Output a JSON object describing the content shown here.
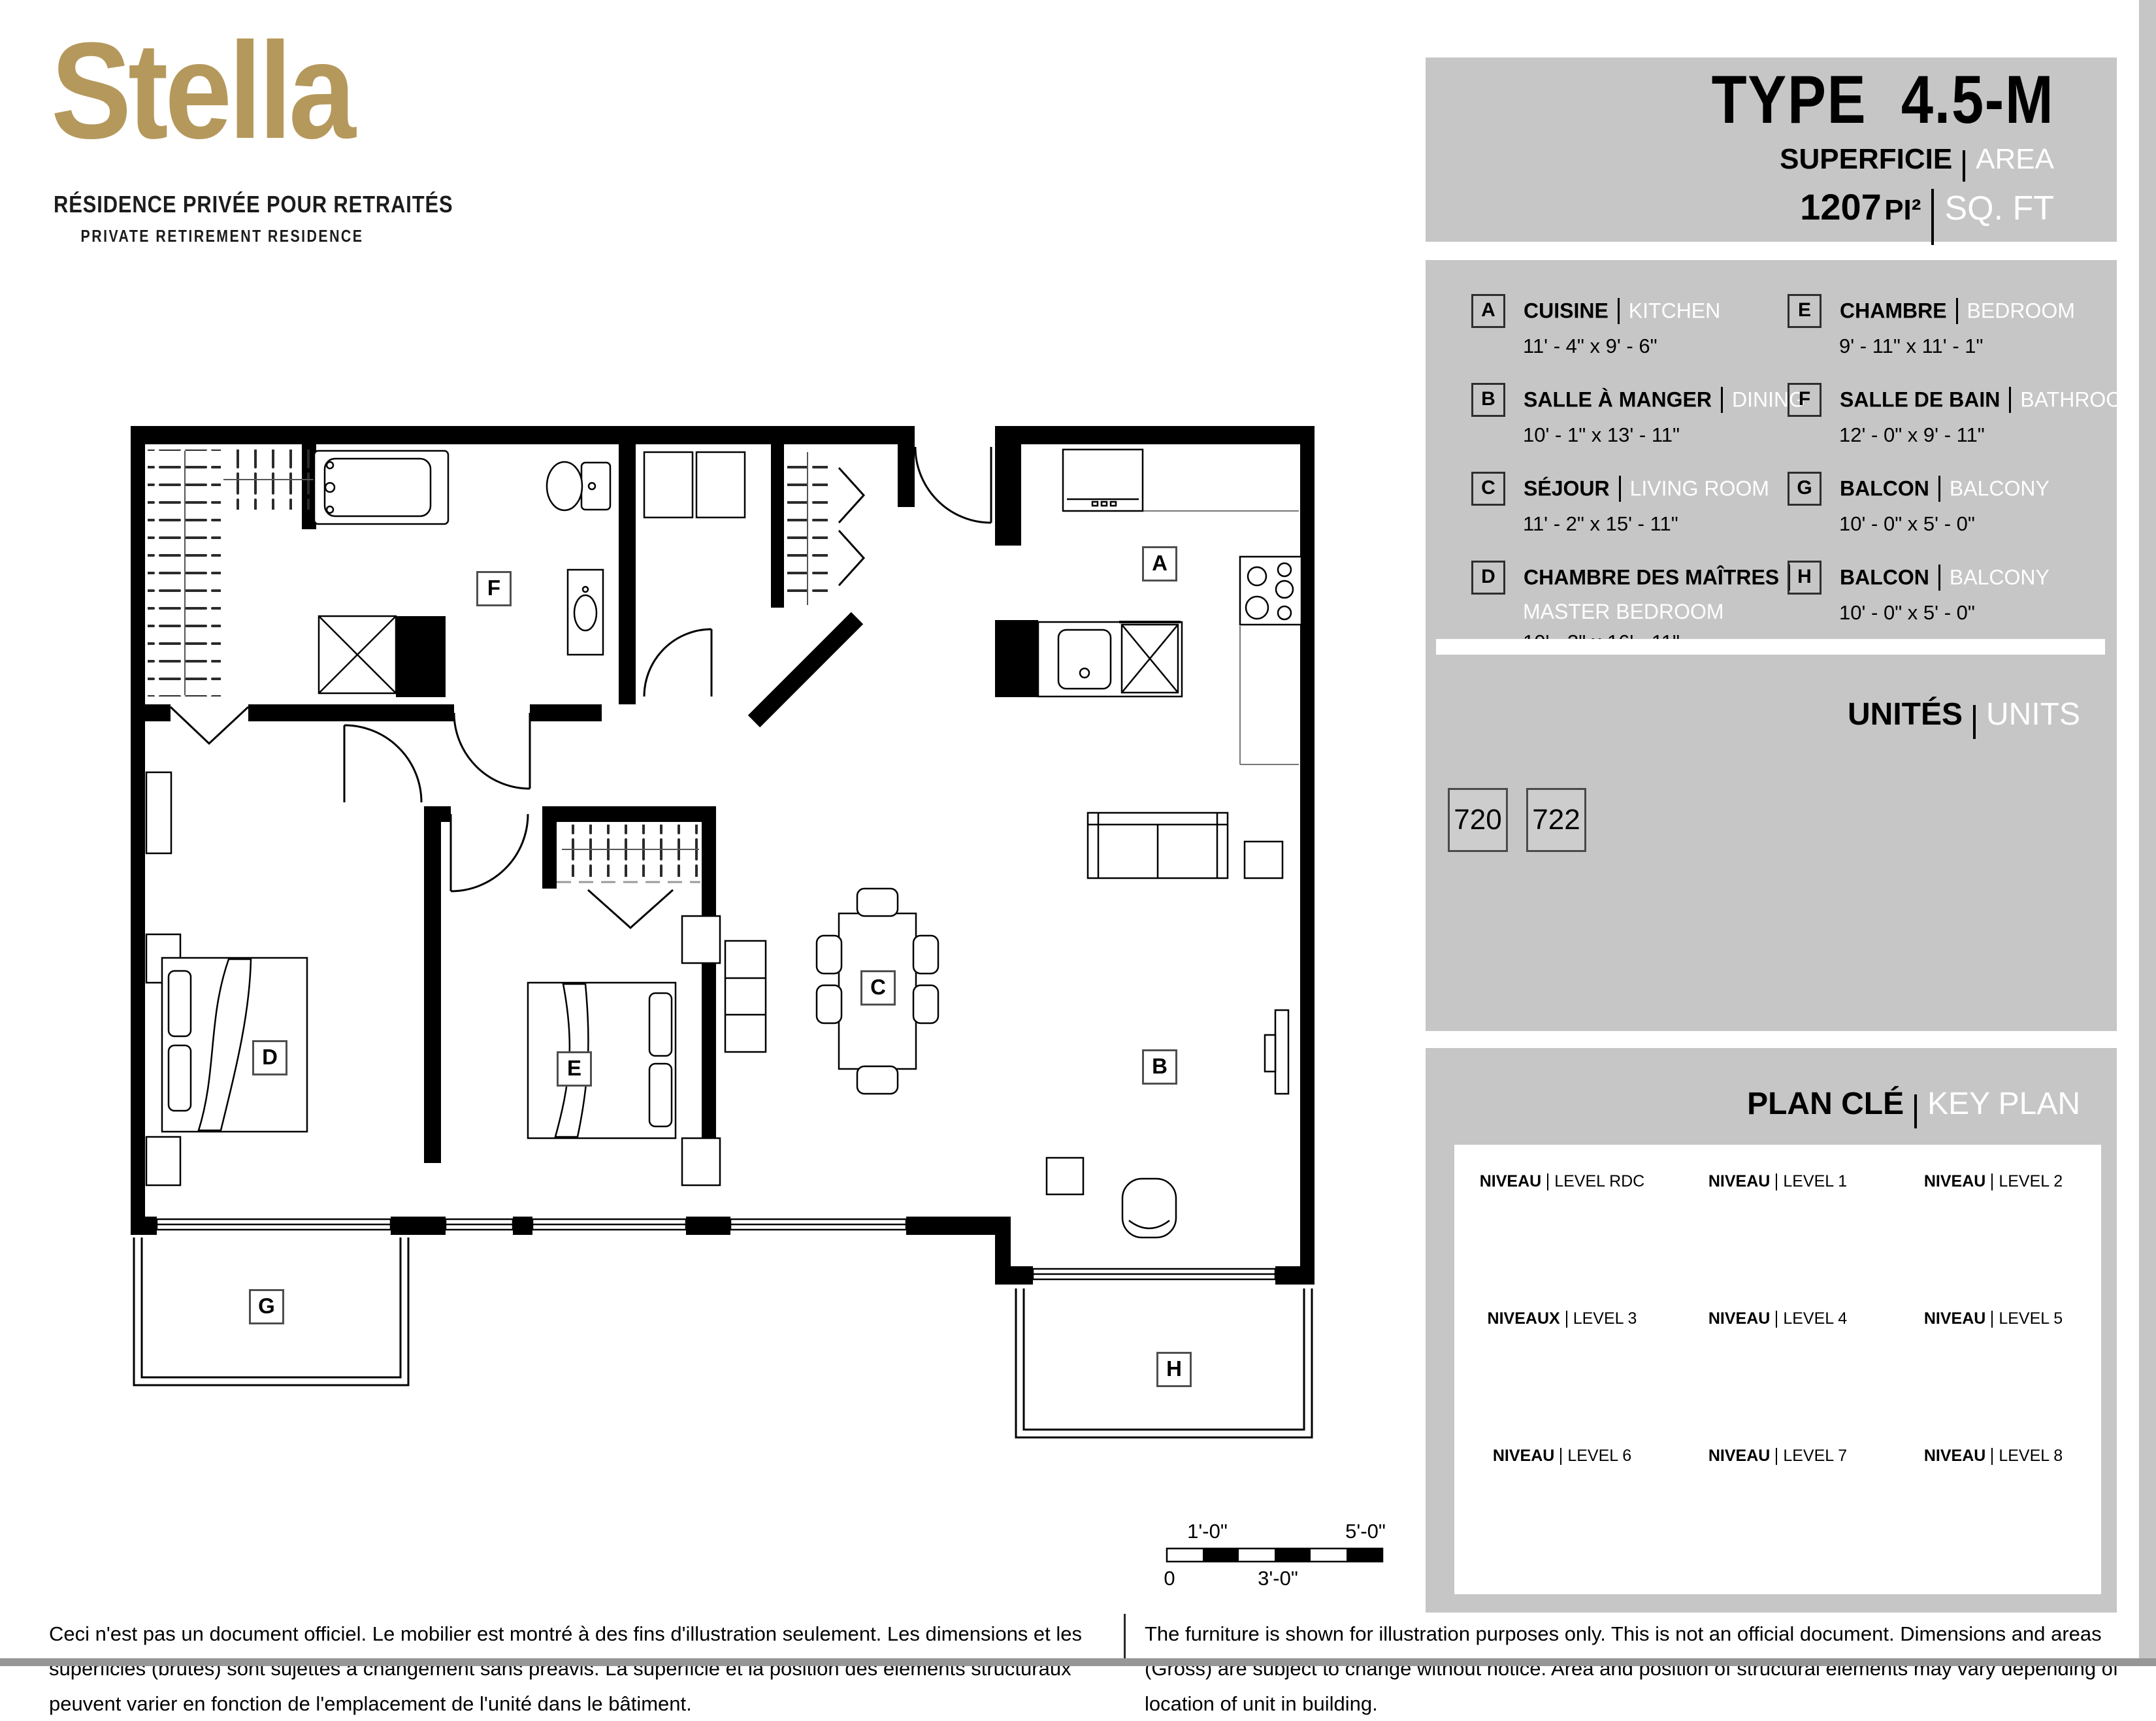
{
  "logo": {
    "name": "Stella",
    "tagline_fr": "RÉSIDENCE PRIVÉE POUR RETRAITÉS",
    "tagline_en": "PRIVATE RETIREMENT RESIDENCE"
  },
  "header": {
    "type_label": "TYPE",
    "type_value": "4.5-M",
    "area_label_fr": "SUPERFICIE",
    "area_label_en": "AREA",
    "area_value": "1207",
    "area_unit_fr": "PI²",
    "area_unit_en": "SQ. FT"
  },
  "legend": {
    "left": [
      {
        "letter": "A",
        "name_fr": "CUISINE",
        "name_en": "KITCHEN",
        "dim": "11' - 4\" x 9' - 6\"",
        "en_below": false
      },
      {
        "letter": "B",
        "name_fr": "SALLE À MANGER",
        "name_en": "DINING",
        "dim": "10' - 1\" x 13' - 11\"",
        "en_below": false
      },
      {
        "letter": "C",
        "name_fr": "SÉJOUR",
        "name_en": "LIVING ROOM",
        "dim": "11' - 2\" x 15' - 11\"",
        "en_below": false
      },
      {
        "letter": "D",
        "name_fr": "CHAMBRE DES MAÎTRES",
        "name_en": "MASTER BEDROOM",
        "dim": "10' - 3\" x 16' - 11\"",
        "en_below": true
      }
    ],
    "right": [
      {
        "letter": "E",
        "name_fr": "CHAMBRE",
        "name_en": "BEDROOM",
        "dim": "9' - 11\" x 11' - 1\"",
        "en_below": false
      },
      {
        "letter": "F",
        "name_fr": "SALLE DE BAIN",
        "name_en": "BATHROOM",
        "dim": "12' - 0\" x 9' - 11\"",
        "en_below": false
      },
      {
        "letter": "G",
        "name_fr": "BALCON",
        "name_en": "BALCONY",
        "dim": "10' - 0\" x 5' - 0\"",
        "en_below": false
      },
      {
        "letter": "H",
        "name_fr": "BALCON",
        "name_en": "BALCONY",
        "dim": "10' - 0\" x 5' - 0\"",
        "en_below": false
      }
    ]
  },
  "units": {
    "label_fr": "UNITÉS",
    "label_en": "UNITS",
    "numbers": [
      "720",
      "722"
    ]
  },
  "keyplan": {
    "title_fr": "PLAN CLÉ",
    "title_en": "KEY PLAN",
    "compass": "N",
    "highlight_color": "#b2a7cb",
    "levels": [
      {
        "fr": "NIVEAU",
        "en": "LEVEL RDC",
        "shape": "rdc",
        "highlight": false
      },
      {
        "fr": "NIVEAU",
        "en": "LEVEL 1",
        "shape": "u",
        "highlight": false
      },
      {
        "fr": "NIVEAU",
        "en": "LEVEL 2",
        "shape": "u",
        "highlight": false
      },
      {
        "fr": "NIVEAUX",
        "en": "LEVEL 3",
        "shape": "u",
        "highlight": false
      },
      {
        "fr": "NIVEAU",
        "en": "LEVEL 4",
        "shape": "u",
        "highlight": false
      },
      {
        "fr": "NIVEAU",
        "en": "LEVEL 5",
        "shape": "u",
        "highlight": false
      },
      {
        "fr": "NIVEAU",
        "en": "LEVEL 6",
        "shape": "seven",
        "highlight": false
      },
      {
        "fr": "NIVEAU",
        "en": "LEVEL 7",
        "shape": "seven",
        "highlight": true
      },
      {
        "fr": "NIVEAU",
        "en": "LEVEL 8",
        "shape": "seven",
        "highlight": false
      }
    ]
  },
  "plan": {
    "room_labels": [
      "A",
      "B",
      "C",
      "D",
      "E",
      "F",
      "G",
      "H"
    ]
  },
  "scalebar": {
    "zero": "0",
    "one": "1'-0\"",
    "three": "3'-0\"",
    "five": "5'-0\""
  },
  "disclaimer": {
    "fr": "Ceci n'est pas un document officiel.  Le mobilier est montré à des fins d'illustration seulement.  Les dimensions et les superficies (brutes) sont sujettes à changement sans préavis. La superficie et la position des éléments structuraux peuvent varier en fonction de l'emplacement de l'unité dans le bâtiment.",
    "en": "The furniture is shown for illustration purposes only.  This is not an official document.  Dimensions and areas (Gross) are subject to change without notice. Area and position of structural elements may vary depending of location of unit in building."
  }
}
